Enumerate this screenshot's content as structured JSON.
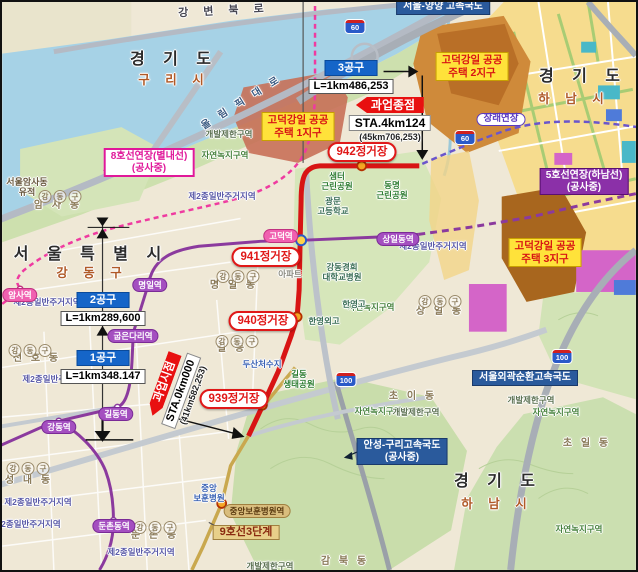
{
  "project": {
    "end_label": "과업종점",
    "end_sta": "STA.4km124",
    "end_note": "(45km706,253)",
    "start_label": "과업시점",
    "start_sta": "STA.0km000",
    "start_note": "(41km582,253)"
  },
  "sections": [
    {
      "name": "1공구",
      "length": "L=1km348.147"
    },
    {
      "name": "2공구",
      "length": "L=1km289,600"
    },
    {
      "name": "3공구",
      "length": "L=1km486,253"
    }
  ],
  "colors": {
    "new_line9_route": "#d81414",
    "line5": "#8b3a9e",
    "line8": "#ef3aa0",
    "line9_phase3": "#c9a84e",
    "section_box": "#1565c8",
    "endpoint_box": "#e81010",
    "water": "#a6d2e6",
    "district_label_bg": "#ffe23a"
  },
  "labels": [
    {
      "n": "road-label-gangbyeon-bukro",
      "c": "road halo",
      "t": "강 변 북 로",
      "x": 222,
      "y": 3,
      "rot": -3
    },
    {
      "n": "region-label-gyeonggi-do-guri",
      "c": "big halo",
      "t": "경 기 도",
      "x": 172,
      "y": 49
    },
    {
      "n": "region-label-guri-si",
      "c": "sub halo",
      "t": "구 리 시",
      "x": 172,
      "y": 71
    },
    {
      "n": "road-label-olympic-daero",
      "c": "road2 halo",
      "t": "올 림 픽 대 로",
      "x": 240,
      "y": 95,
      "rot": -32
    },
    {
      "n": "region-label-gyeonggi-do-hanam-top",
      "c": "big halo",
      "t": "경 기 도",
      "x": 581,
      "y": 66
    },
    {
      "n": "region-label-hanam-si-top",
      "c": "sub halo",
      "t": "하 남 시",
      "x": 572,
      "y": 90
    },
    {
      "n": "region-label-seoul",
      "c": "big halo",
      "t": "서 울 특 별 시",
      "x": 89,
      "y": 244
    },
    {
      "n": "region-label-gangdong-gu",
      "c": "sub halo",
      "t": "강 동 구",
      "x": 90,
      "y": 264
    },
    {
      "n": "region-label-gyeonggi-do-hanam-bottom",
      "c": "big halo",
      "t": "경 기 도",
      "x": 496,
      "y": 471
    },
    {
      "n": "region-label-hanam-si-bottom",
      "c": "sub halo",
      "t": "하 남 시",
      "x": 495,
      "y": 495
    },
    {
      "n": "ruins-label-amsa",
      "c": "ruin halo",
      "lines": [
        "서울암사동",
        "유적"
      ],
      "x": 25,
      "y": 175
    },
    {
      "n": "dong-label-amsa",
      "c": "dong halo",
      "t": "암 사 동",
      "x": 56,
      "y": 198
    },
    {
      "n": "dong-label-cheonho",
      "c": "dong halo",
      "t": "천 호 동",
      "x": 35,
      "y": 351
    },
    {
      "n": "dong-label-seongnae",
      "c": "dong halo",
      "t": "성 내 동",
      "x": 27,
      "y": 473
    },
    {
      "n": "dong-label-myeongil",
      "c": "dong halo",
      "t": "명 일 동",
      "x": 232,
      "y": 278
    },
    {
      "n": "dong-label-gil",
      "c": "dong halo",
      "t": "길 동",
      "x": 230,
      "y": 341
    },
    {
      "n": "dong-label-dunchon",
      "c": "dong halo",
      "t": "둔 촌 동",
      "x": 153,
      "y": 528
    },
    {
      "n": "dong-label-sangil",
      "c": "dong halo",
      "t": "상 일 동",
      "x": 438,
      "y": 304
    },
    {
      "n": "dong-label-choi",
      "c": "dong halo",
      "t": "초 이 동",
      "x": 411,
      "y": 389
    },
    {
      "n": "dong-label-choil",
      "c": "dong halo",
      "t": "초 일 동",
      "x": 585,
      "y": 436
    },
    {
      "n": "dong-label-gambuk",
      "c": "dong halo",
      "t": "감 북 동",
      "x": 343,
      "y": 554
    },
    {
      "n": "gu-badge-amsa",
      "c": "badge",
      "t": "강동구",
      "x": 58,
      "y": 184
    },
    {
      "n": "gu-badge-cheonho",
      "c": "badge",
      "t": "강동구",
      "x": 28,
      "y": 338
    },
    {
      "n": "gu-badge-seongnae",
      "c": "badge",
      "t": "강동구",
      "x": 26,
      "y": 456
    },
    {
      "n": "gu-badge-myeongil",
      "c": "badge",
      "t": "강동구",
      "x": 236,
      "y": 264
    },
    {
      "n": "gu-badge-gildong",
      "c": "badge",
      "t": "강동구",
      "x": 235,
      "y": 329
    },
    {
      "n": "gu-badge-dunchon",
      "c": "badge",
      "t": "강동구",
      "x": 153,
      "y": 515
    },
    {
      "n": "gu-badge-sangil",
      "c": "badge",
      "t": "강동구",
      "x": 438,
      "y": 289
    },
    {
      "n": "zone-label-residential-1",
      "c": "zone halo",
      "t": "제2종일반주거지역",
      "x": 220,
      "y": 190
    },
    {
      "n": "zone-label-residential-2",
      "c": "zone halo",
      "t": "제2종일반주거지역",
      "x": 45,
      "y": 296
    },
    {
      "n": "zone-label-residential-3",
      "c": "zone halo",
      "t": "제2종일반주거지역",
      "x": 431,
      "y": 240
    },
    {
      "n": "zone-label-residential-4",
      "c": "zone halo",
      "t": "제2종일반주거지역",
      "x": 54,
      "y": 373
    },
    {
      "n": "zone-label-residential-5",
      "c": "zone halo",
      "t": "제2종일반주거지역",
      "x": 36,
      "y": 496
    },
    {
      "n": "zone-label-residential-6",
      "c": "zone halo",
      "t": "제2종일반주거지역",
      "x": 25,
      "y": 518
    },
    {
      "n": "zone-label-residential-7",
      "c": "zone halo",
      "t": "제2종일반주거지역",
      "x": 139,
      "y": 546
    },
    {
      "n": "zone-label-greenbelt-1",
      "c": "gz halo",
      "t": "자연녹지구역",
      "x": 223,
      "y": 149
    },
    {
      "n": "zone-label-greenbelt-2",
      "c": "gz halo",
      "t": "자연녹지구역",
      "x": 369,
      "y": 301
    },
    {
      "n": "zone-label-greenbelt-3",
      "c": "gz halo",
      "t": "자연녹지구역",
      "x": 376,
      "y": 405
    },
    {
      "n": "zone-label-greenbelt-4",
      "c": "gz halo",
      "t": "자연녹지구역",
      "x": 554,
      "y": 406
    },
    {
      "n": "zone-label-greenbelt-5",
      "c": "gz halo",
      "t": "자연녹지구역",
      "x": 577,
      "y": 523
    },
    {
      "n": "zone-label-restricted-1",
      "c": "gb halo",
      "t": "개발제한구역",
      "x": 227,
      "y": 128
    },
    {
      "n": "zone-label-restricted-2",
      "c": "gb halo",
      "t": "개발제한구역",
      "x": 414,
      "y": 406
    },
    {
      "n": "zone-label-restricted-3",
      "c": "gb halo",
      "t": "개발제한구역",
      "x": 529,
      "y": 394
    },
    {
      "n": "zone-label-restricted-4",
      "c": "gb halo",
      "t": "개발제한구역",
      "x": 268,
      "y": 560
    },
    {
      "n": "park-label-saemteo",
      "c": "park halo",
      "lines": [
        "샘터",
        "근린공원"
      ],
      "x": 335,
      "y": 170
    },
    {
      "n": "park-label-dongmyeong",
      "c": "park halo",
      "lines": [
        "동명",
        "근린공원"
      ],
      "x": 390,
      "y": 179
    },
    {
      "n": "park-label-gildong-eco",
      "c": "park halo",
      "lines": [
        "길동",
        "생태공원"
      ],
      "x": 297,
      "y": 368
    },
    {
      "n": "facility-label-gwangmun-high",
      "c": "fac halo",
      "lines": [
        "광문",
        "고등학교"
      ],
      "x": 331,
      "y": 195
    },
    {
      "n": "facility-label-kyunghee-hospital",
      "c": "fac halo",
      "lines": [
        "강동경희",
        "대학교병원"
      ],
      "x": 340,
      "y": 261
    },
    {
      "n": "facility-label-hanyoung-high",
      "c": "fac halo",
      "t": "한영고",
      "x": 352,
      "y": 298
    },
    {
      "n": "facility-label-hanyoung-foreign",
      "c": "fac halo",
      "t": "한영외고",
      "x": 322,
      "y": 315
    },
    {
      "n": "facility-label-apartment",
      "c": "fac2 halo",
      "t": "아파트",
      "x": 288,
      "y": 268
    },
    {
      "n": "facility-label-dusan-reservoir",
      "c": "facb halo",
      "t": "두산처수지",
      "x": 260,
      "y": 358
    },
    {
      "n": "facility-label-bohun-hospital",
      "c": "facb halo",
      "lines": [
        "중앙",
        "보훈병원"
      ],
      "x": 207,
      "y": 482
    },
    {
      "n": "station-amsa",
      "c": "metro8",
      "t": "암사역",
      "x": 18,
      "y": 286
    },
    {
      "n": "station-gangdong",
      "c": "metro5",
      "t": "강동역",
      "x": 57,
      "y": 418
    },
    {
      "n": "station-gildong",
      "c": "metro5",
      "t": "길동역",
      "x": 114,
      "y": 405
    },
    {
      "n": "station-gubeundari",
      "c": "metro5",
      "t": "굽은다리역",
      "x": 131,
      "y": 327
    },
    {
      "n": "station-myeongil",
      "c": "metro5",
      "t": "명일역",
      "x": 148,
      "y": 276
    },
    {
      "n": "station-godeok",
      "c": "metro8",
      "t": "고덕역",
      "x": 279,
      "y": 227
    },
    {
      "n": "station-sangildong",
      "c": "metro5",
      "t": "상일동역",
      "x": 396,
      "y": 230
    },
    {
      "n": "station-dunchondong",
      "c": "metro5",
      "t": "둔촌동역",
      "x": 112,
      "y": 517
    },
    {
      "n": "station-bohun-hospital",
      "c": "metro9",
      "t": "중앙보훈병원역",
      "x": 255,
      "y": 502
    },
    {
      "n": "project-station-942",
      "c": "soval",
      "t": "942정거장",
      "x": 360,
      "y": 140
    },
    {
      "n": "project-station-941",
      "c": "soval",
      "t": "941정거장",
      "x": 264,
      "y": 245
    },
    {
      "n": "project-station-940",
      "c": "soval",
      "t": "940정거장",
      "x": 261,
      "y": 309
    },
    {
      "n": "project-station-939",
      "c": "soval",
      "t": "939정거장",
      "x": 232,
      "y": 387
    },
    {
      "n": "line-label-line8-extension",
      "c": "pinkbox",
      "lines": [
        "8호선연장(별내선)",
        "(공사중)"
      ],
      "x": 147,
      "y": 146
    },
    {
      "n": "line-label-line5-extension",
      "c": "purplebox",
      "lines": [
        "5호선연장(하남선)",
        "(공사중)"
      ],
      "x": 582,
      "y": 166
    },
    {
      "n": "road-label-anseong-guri",
      "c": "bluebox",
      "lines": [
        "안성-구리고속국도",
        "(공사중)"
      ],
      "x": 400,
      "y": 436
    },
    {
      "n": "road-label-outer-ring",
      "c": "bluebox",
      "t": "서울외곽순환고속국도",
      "x": 523,
      "y": 368
    },
    {
      "n": "road-label-seoul-yangyang",
      "c": "bluebox",
      "t": "서울-양양 고속국도",
      "x": 441,
      "y": -3
    },
    {
      "n": "line-label-line9-phase3",
      "c": "tanbox",
      "t": "9호선3단계",
      "x": 244,
      "y": 523
    },
    {
      "n": "label-future-extension",
      "c": "future",
      "t": "장래연장",
      "x": 499,
      "y": 111
    },
    {
      "n": "district-label-godeok-gangil-1",
      "c": "ybox",
      "lines": [
        "고덕강일 공공",
        "주택 1지구"
      ],
      "x": 296,
      "y": 110
    },
    {
      "n": "district-label-godeok-gangil-2",
      "c": "ybox",
      "lines": [
        "고덕강일 공공",
        "주택 2지구"
      ],
      "x": 470,
      "y": 50
    },
    {
      "n": "district-label-godeok-gangil-3",
      "c": "ybox",
      "lines": [
        "고덕강일 공공",
        "주택 3지구"
      ],
      "x": 543,
      "y": 236
    }
  ],
  "shields": [
    {
      "n": "route-shield-60-a",
      "t": "60",
      "x": 353,
      "y": 17
    },
    {
      "n": "route-shield-60-b",
      "t": "60",
      "x": 463,
      "y": 128
    },
    {
      "n": "route-shield-100-a",
      "t": "100",
      "x": 560,
      "y": 347
    },
    {
      "n": "route-shield-100-b",
      "t": "100",
      "x": 344,
      "y": 370
    }
  ]
}
